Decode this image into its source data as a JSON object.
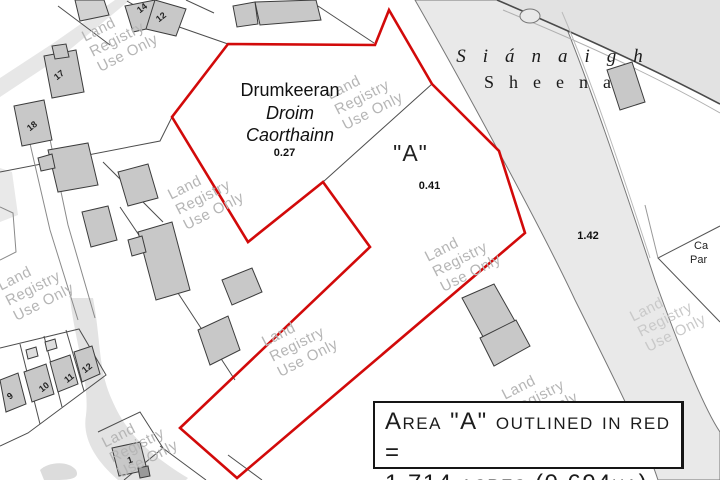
{
  "map": {
    "townland_primary": "Drumkeeran",
    "townland_irish_line1": "Droim",
    "townland_irish_line2": "Caorthainn",
    "area_drumkeeran": "0.27",
    "parcel_a": "\"A\"",
    "area_parcel_a": "0.41",
    "adjacent_townland_irish": "Siánaigh",
    "adjacent_townland_english": "Sheena",
    "area_road_strip": "1.42",
    "edge_label_line1": "Ca",
    "edge_label_line2": "Par",
    "house_numbers": [
      "14",
      "12",
      "17",
      "18",
      "9",
      "10",
      "11",
      "12",
      "1"
    ]
  },
  "watermark": {
    "line1": "Land",
    "line2": "Registry",
    "line3": "Use Only"
  },
  "annotation": {
    "line1": "Area \"A\" outlined in red =",
    "line2": "1.714 acres (0.694ha)"
  },
  "colors": {
    "boundary_red": "#d20a0a",
    "building_fill": "#c8c8c8",
    "road_fill": "#e7e7e7",
    "watermark_gray": "#b5b5b5"
  }
}
